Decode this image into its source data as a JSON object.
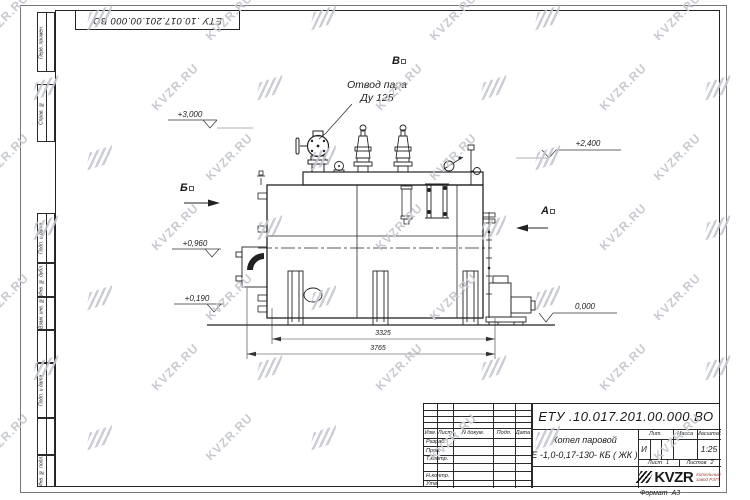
{
  "watermark": {
    "text": "KVZR.RU"
  },
  "top_stamp": {
    "doc_number": "ЕТУ .10.017.201.00.000  ВО"
  },
  "margin_fields": [
    {
      "label": "Перв. примен.",
      "top": 12,
      "height": 60
    },
    {
      "label": "Справ. №",
      "top": 84,
      "height": 58
    },
    {
      "label": "Подп. и дата",
      "top": 213,
      "height": 50
    },
    {
      "label": "Инв. № дубл.",
      "top": 263,
      "height": 34
    },
    {
      "label": "Взам. инв. №",
      "top": 297,
      "height": 33
    },
    {
      "label": "",
      "top": 330,
      "height": 33
    },
    {
      "label": "Подп. и дата",
      "top": 363,
      "height": 55
    },
    {
      "label": "",
      "top": 418,
      "height": 37
    },
    {
      "label": "Инв. № подл.",
      "top": 455,
      "height": 32
    }
  ],
  "drawing": {
    "callout_line1": "Отвод пара",
    "callout_line2": "Ду 125",
    "view_b": "Б",
    "view_a": "А",
    "view_v": "В",
    "elevations": {
      "e3000": "+3,000",
      "e2400": "+2,400",
      "e0960": "+0,960",
      "e0190": "+0,190",
      "e0000": "0,000"
    },
    "dim_3325": "3325",
    "dim_3765": "3765"
  },
  "title_block": {
    "doc_number": "ЕТУ .10.017.201.00.000  ВО",
    "product_name_line1": "Котел паровой",
    "product_name_line2": "Е -1,0-0,17-130- КБ ( ЖК )",
    "col_izm": "Изм.",
    "col_list": "Лист",
    "col_ndoc": "N докум.",
    "col_podp": "Подп.",
    "col_data": "Дата",
    "row_razrab": "Разраб.",
    "row_prov": "Пров.",
    "row_tkontr": "Т.контр.",
    "row_nkontr": "Н.контр.",
    "row_utv": "Утв.",
    "lit_header": "Лит.",
    "mass_header": "Масса",
    "scale_header": "Масштаб",
    "lit_value": "И",
    "scale_value": "1:25",
    "sheet_label": "Лист",
    "sheet_value": "1",
    "sheets_label": "Листов",
    "sheets_value": "2",
    "logo_text": "KVZR",
    "logo_sub1": "Котельный",
    "logo_sub2": "завод РЭП",
    "format_label": "Формат",
    "format_value": "А3"
  }
}
